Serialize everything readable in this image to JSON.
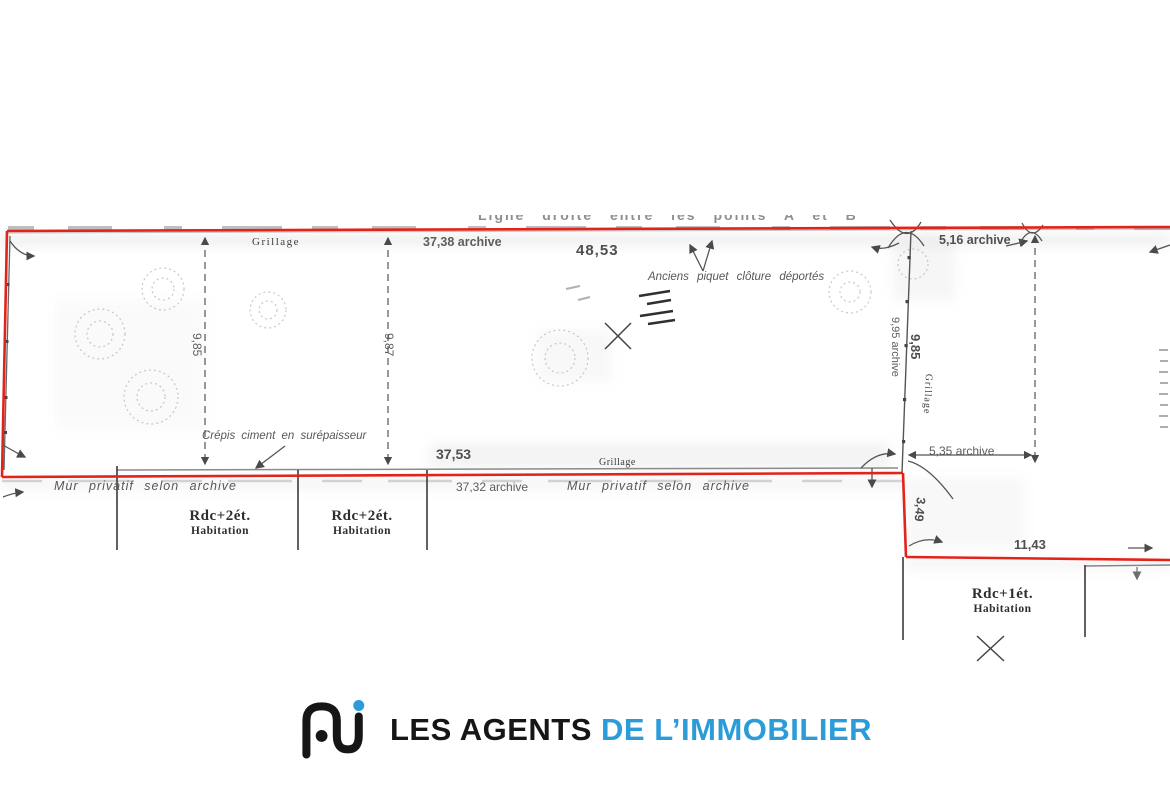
{
  "plan": {
    "colors": {
      "boundary_red": "#e2231a",
      "survey_gray": "#555555",
      "brand_blue": "#2b9cd8"
    },
    "top_note": "Ligne droite entre les points A et B",
    "fence_top_label": "Grillage",
    "dims": {
      "d37_38": "37,38 archive",
      "d48_53": "48,53",
      "d5_16": "5,16 archive",
      "d9_85_left": "9,85",
      "d9_87": "9,87",
      "d9_95": "9,95 archive",
      "d9_85_right": "9,85",
      "d37_53": "37,53",
      "d37_32": "37,32 archive",
      "d5_35": "5,35 archive",
      "d3_49": "3,49",
      "d11_43": "11,43"
    },
    "notes": {
      "anciens_piquet": "Anciens piquet clôture déportés",
      "crepis": "Crépis ciment en surépaisseur",
      "mur_left": "Mur privatif selon archive",
      "mur_center": "Mur privatif selon archive",
      "grillage_right": "Grillage",
      "grillage_bottom": "Grillage"
    },
    "buildings": [
      {
        "type": "Rdc+2ét.",
        "use": "Habitation"
      },
      {
        "type": "Rdc+2ét.",
        "use": "Habitation"
      },
      {
        "type": "Rdc+1ét.",
        "use": "Habitation"
      }
    ]
  },
  "footer": {
    "brand_black": "LES AGENTS",
    "brand_blue": "DE L’IMMOBILIER"
  }
}
